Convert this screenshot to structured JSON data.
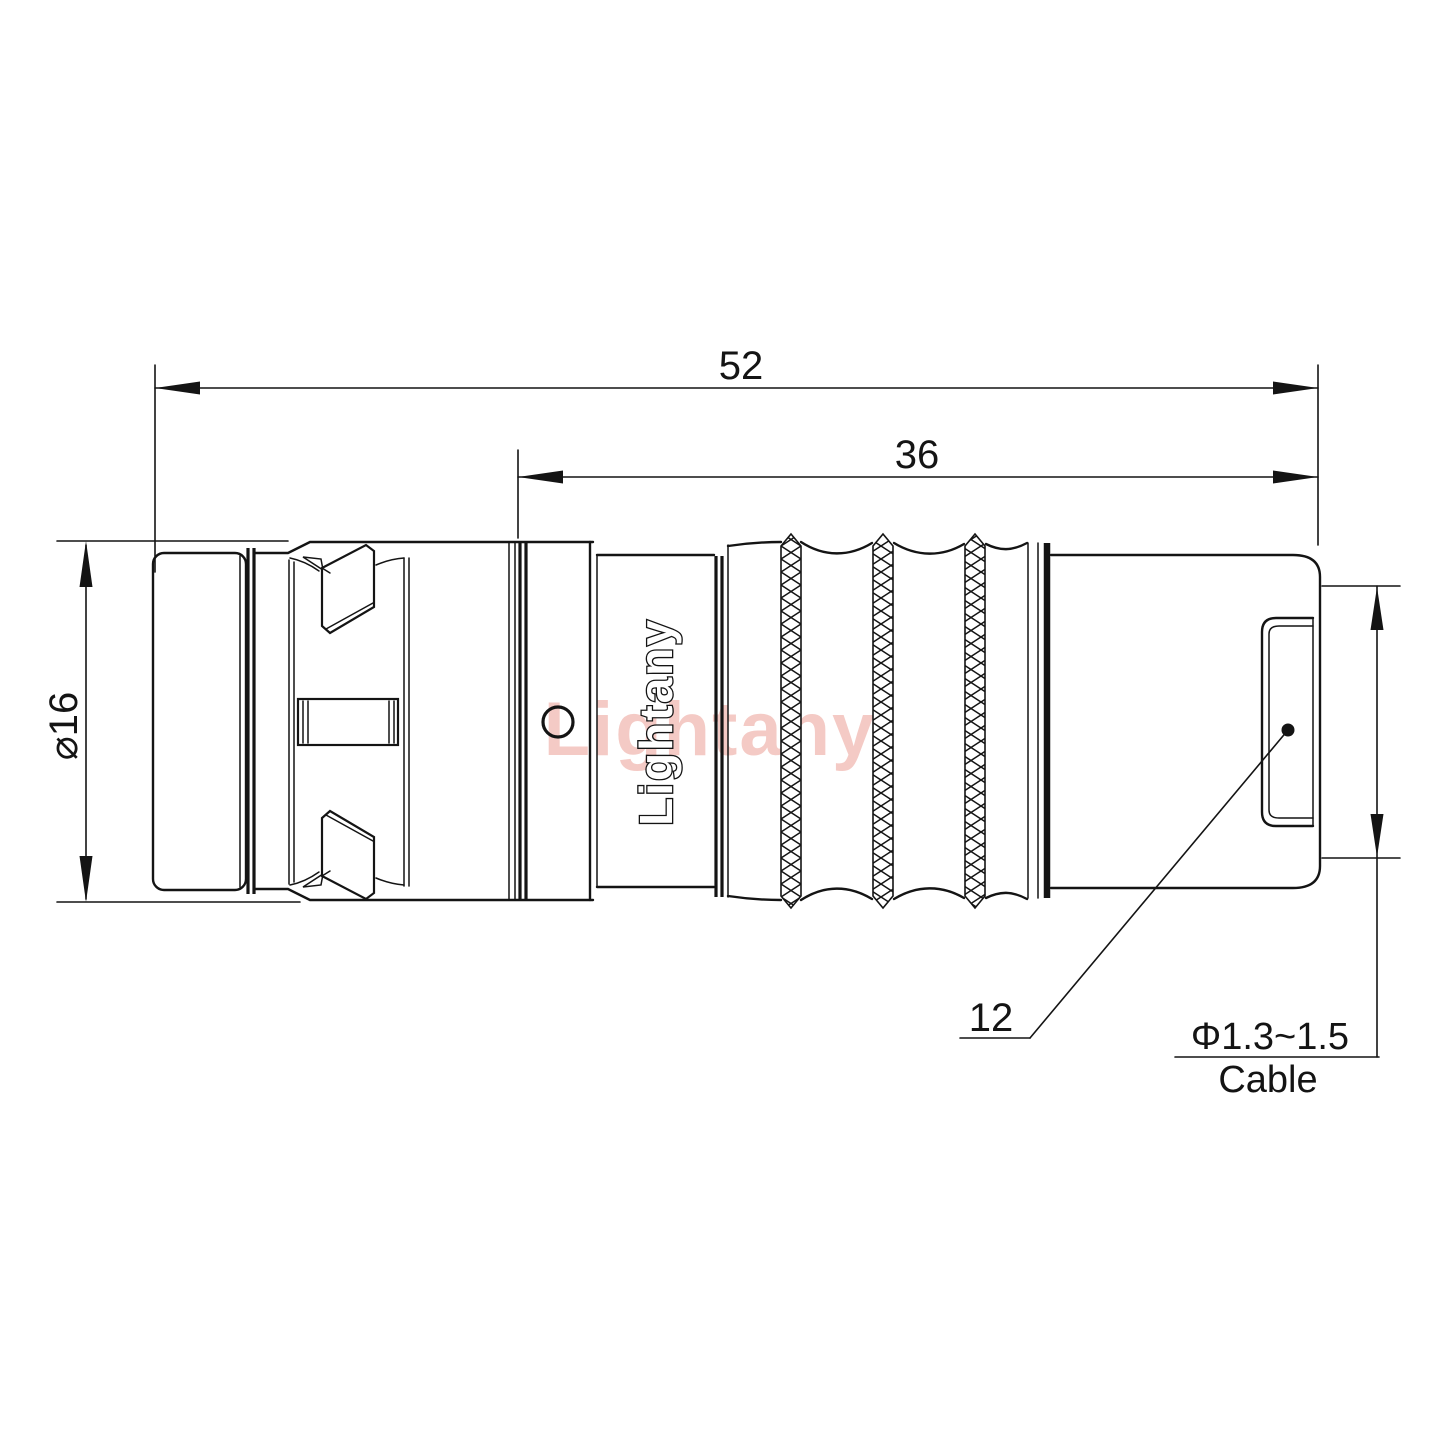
{
  "drawing": {
    "type": "engineering-drawing",
    "subject": "push-pull circular connector plug, side view",
    "dimensions": {
      "overall_length": "52",
      "body_length": "36",
      "shell_diameter": "⌀16",
      "rear_nut_length": "12",
      "cable_diameter": "Φ1.3~1.5",
      "cable_label": "Cable"
    },
    "branding": {
      "logo_text": "Lightany",
      "watermark_text": "Lightany"
    },
    "colors": {
      "line": "#141414",
      "watermark": "#e57c6f",
      "background": "#ffffff"
    }
  }
}
